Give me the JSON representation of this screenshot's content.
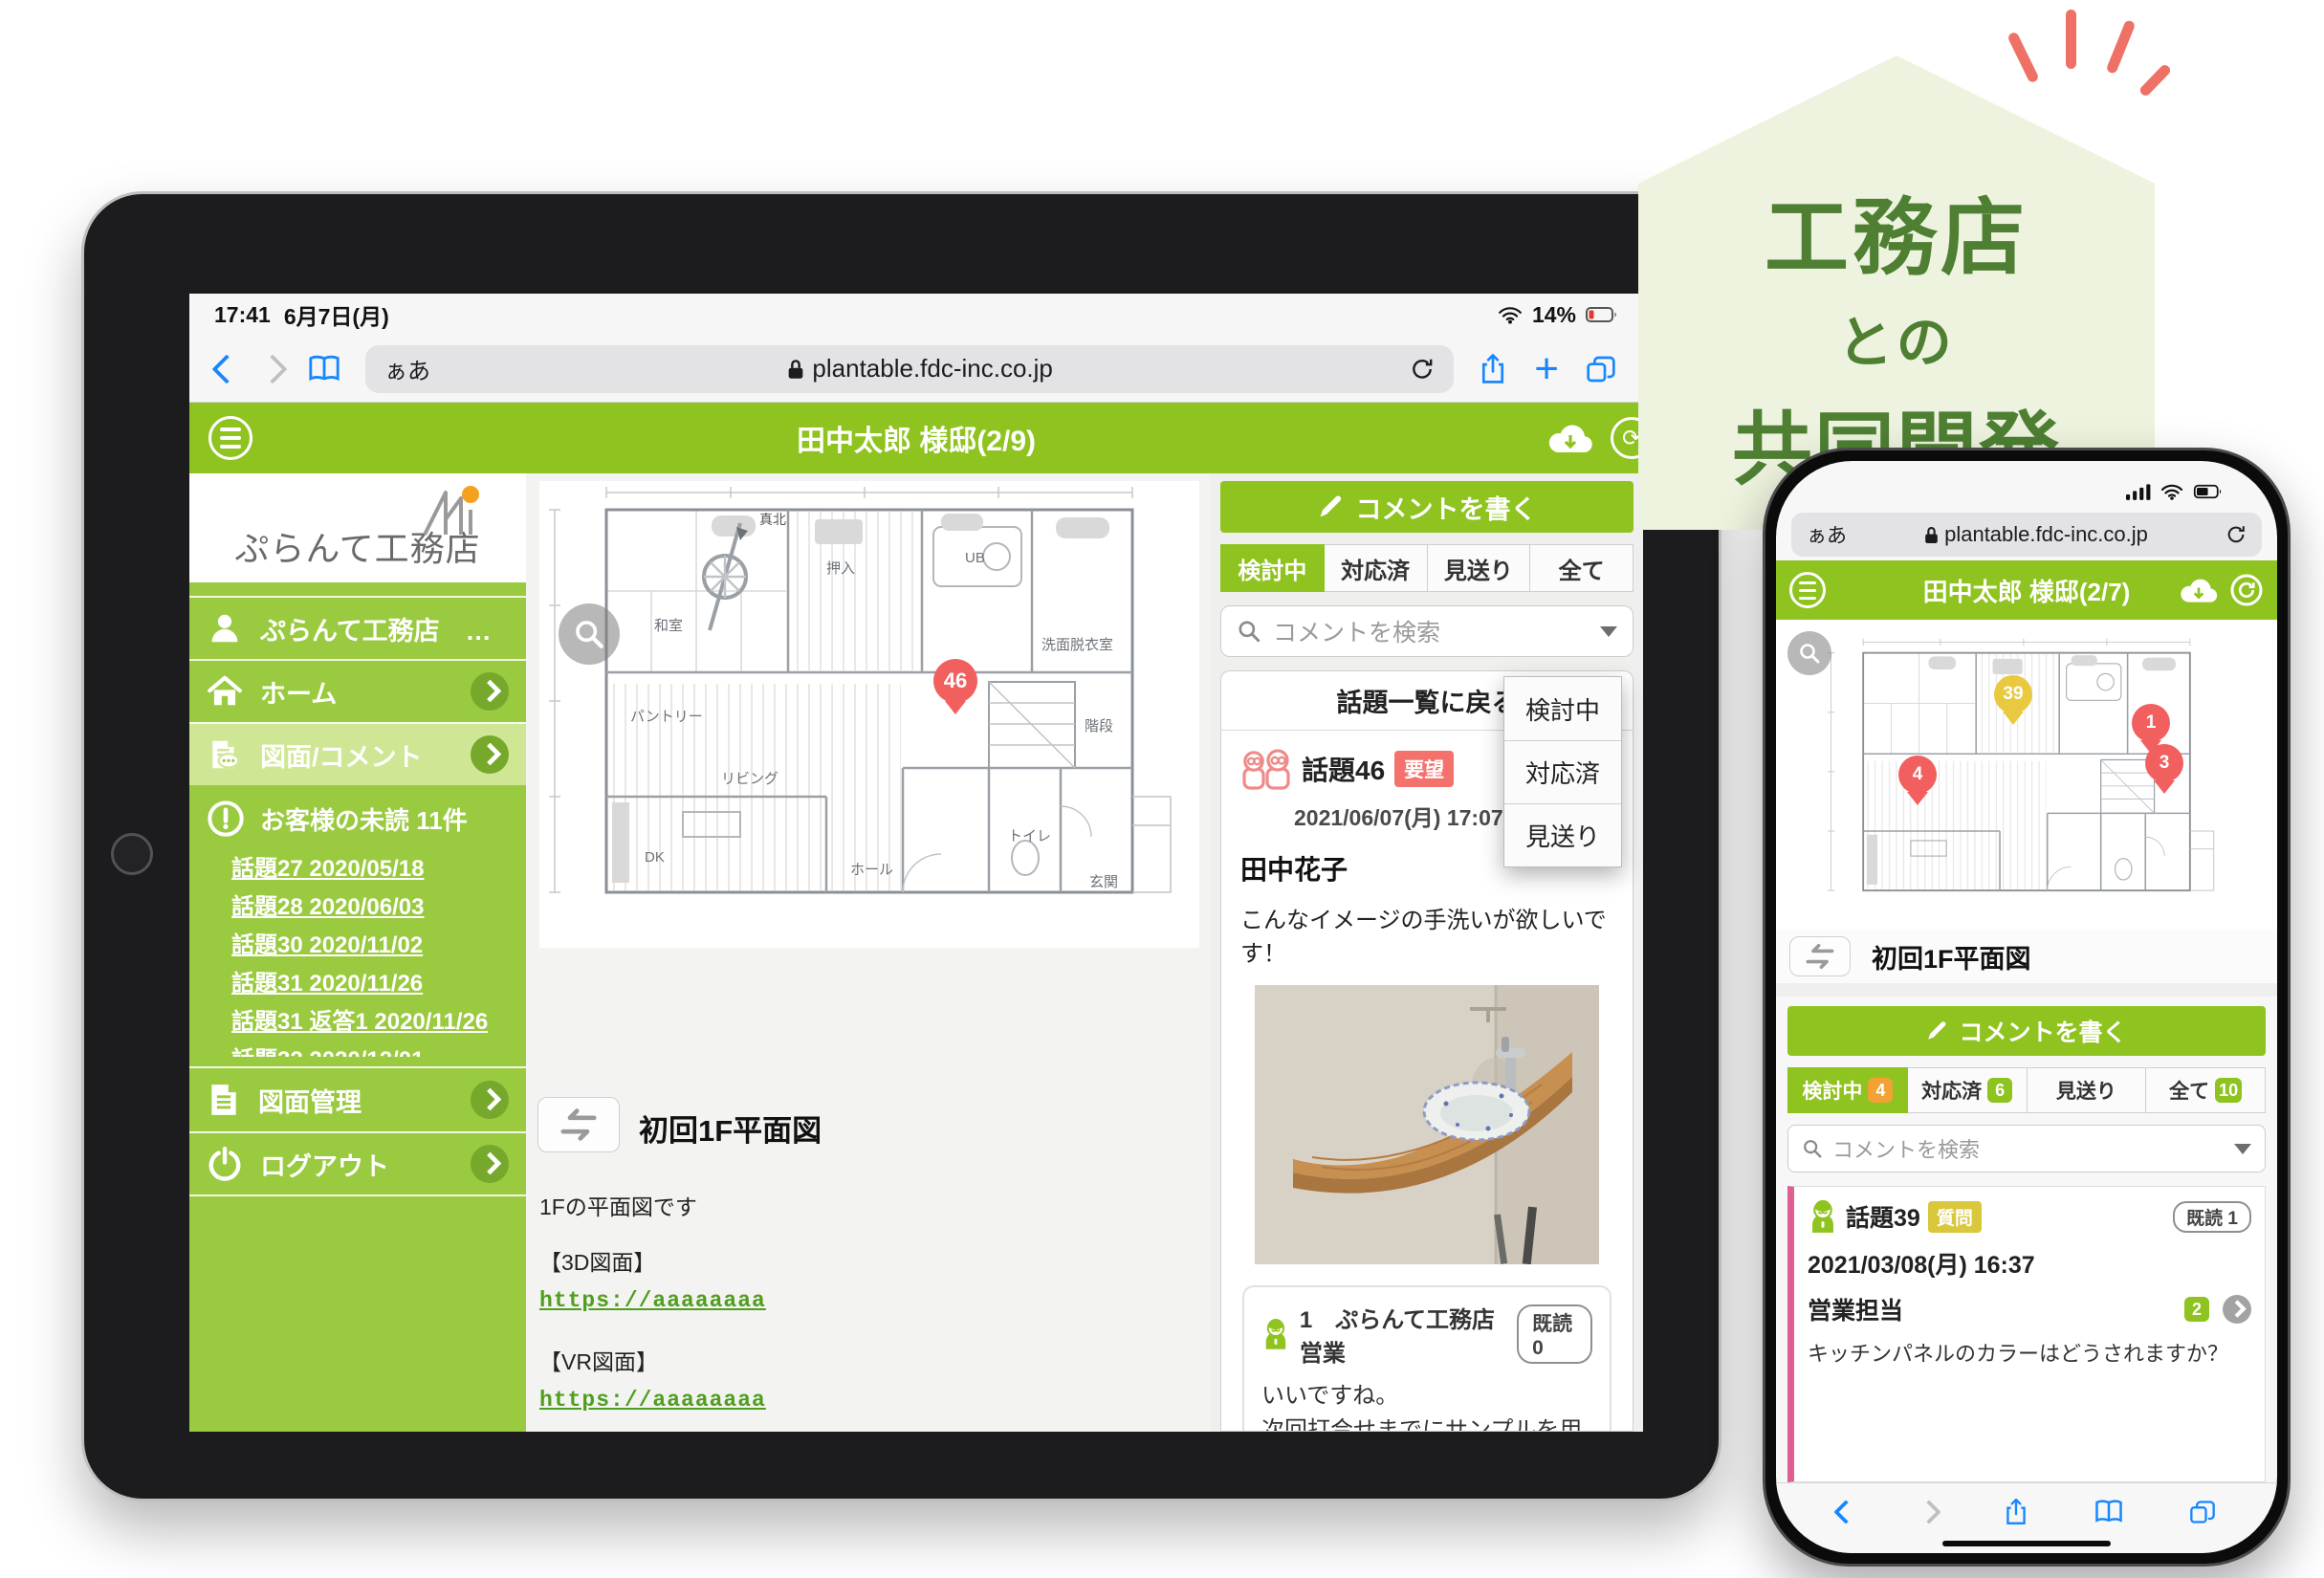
{
  "badge": {
    "l1": "工務店",
    "l2": "との",
    "l3": "共同開発"
  },
  "ipad": {
    "status": {
      "time": "17:41",
      "date": "6月7日(月)",
      "battery": "14%"
    },
    "url": {
      "reader": "ぁあ",
      "host": "plantable.fdc-inc.co.jp"
    },
    "title": "田中太郎 様邸(2/9)",
    "sidebar": {
      "logo": "ぷらんて工務店",
      "account": "ぷらんて工務店　…",
      "home": "ホーム",
      "plans": "図面/コメント",
      "unread": "お客様の未読 11件",
      "links": [
        "話題27 2020/05/18",
        "話題28 2020/06/03",
        "話題30 2020/11/02",
        "話題31 2020/11/26",
        "話題31 返答1 2020/11/26",
        "話題32 2020/12/01"
      ],
      "manage": "図面管理",
      "logout": "ログアウト"
    },
    "plan": {
      "pin": "46",
      "compass": "真北",
      "rooms": [
        "和室",
        "押入",
        "パントリー",
        "UB",
        "洗面脱衣室",
        "リビング",
        "階段",
        "DK",
        "ホール",
        "トイレ",
        "玄関"
      ]
    },
    "doc": {
      "title": "初回1F平面図",
      "desc": "1Fの平面図です",
      "label3d": "【3D図面】",
      "link3d": "https://aaaaaaaa",
      "labelvr": "【VR図面】",
      "linkvr": "https://aaaaaaaa"
    },
    "panel": {
      "write": "コメントを書く",
      "tabs": [
        "検討中",
        "対応済",
        "見送り",
        "全て"
      ],
      "search": "コメントを検索",
      "back": "話題一覧に戻る",
      "menu": [
        "検討中",
        "対応済",
        "見送り"
      ],
      "topic": {
        "name": "話題46",
        "tag": "要望",
        "time": "2021/06/07(月) 17:07",
        "author": "田中花子",
        "msg": "こんなイメージの手洗いが欲しいです！"
      },
      "reply": {
        "num": "1",
        "org": "ぷらんて工務店　営業",
        "read": "既読 0",
        "l1": "いいですね。",
        "l2": "次回打合せまでにサンプルを用意致します。",
        "time": "2021/06/07(月) 17:08"
      }
    }
  },
  "iphone": {
    "url": {
      "reader": "ぁあ",
      "host": "plantable.fdc-inc.co.jp"
    },
    "title": "田中太郎 様邸(2/7)",
    "pins": {
      "p39": "39",
      "p1": "1",
      "p3": "3",
      "p4": "4"
    },
    "doc_title": "初回1F平面図",
    "write": "コメントを書く",
    "tabs": [
      {
        "label": "検討中",
        "count": "4"
      },
      {
        "label": "対応済",
        "count": "6"
      },
      {
        "label": "見送り"
      },
      {
        "label": "全て",
        "count": "10"
      }
    ],
    "search": "コメントを検索",
    "card": {
      "name": "話題39",
      "tag": "質問",
      "read": "既読 1",
      "time": "2021/03/08(月) 16:37",
      "author": "営業担当",
      "count": "2",
      "msg": "キッチンパネルのカラーはどうされますか？"
    }
  }
}
